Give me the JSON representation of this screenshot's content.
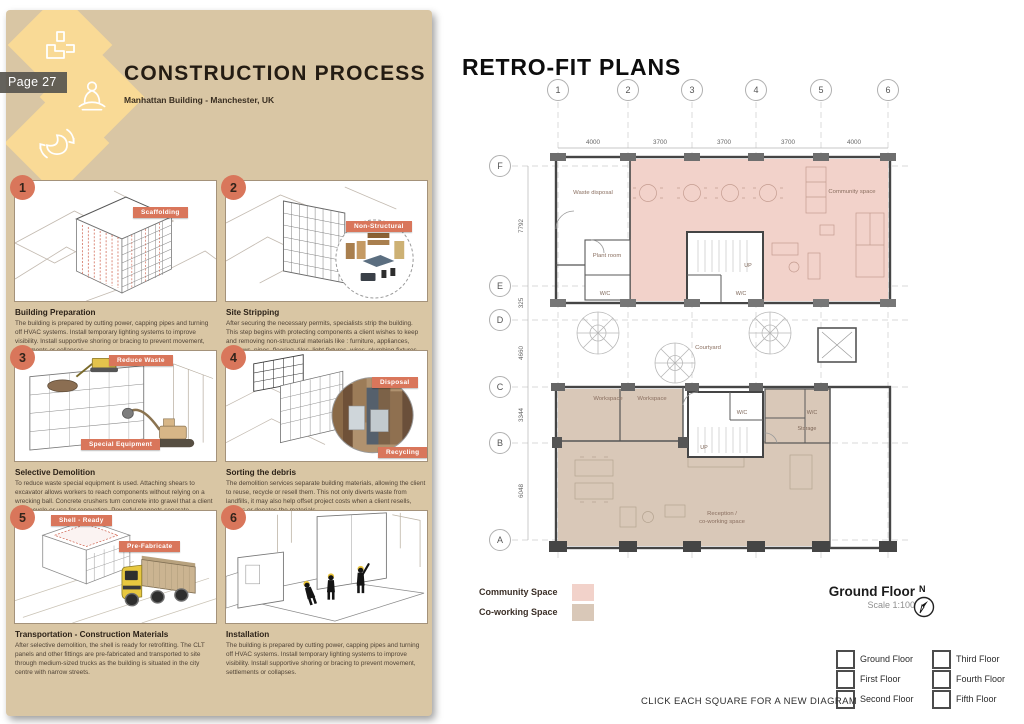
{
  "page_badge": "Page 27",
  "left": {
    "title": "CONSTRUCTION PROCESS",
    "subtitle": "Manhattan Building - Manchester, UK",
    "steps": [
      {
        "num": "1",
        "heading": "Building Preparation",
        "tag1": "Scaffolding",
        "body": "The building is prepared by cutting power, capping pipes and turning off HVAC systems. Install temporary lighting systems to improve visibility. Install supportive shoring or bracing to prevent movement, settlements or collapses."
      },
      {
        "num": "2",
        "heading": "Site Stripping",
        "tag1": "Non-Structural",
        "body": "After securing the necessary permits, specialists strip the building. This step begins with protecting components a client wishes to keep and removing non-structural materials like : furniture, appliances, windows, pipes, flooring, tiles, light fixtures, wires, plumbing fixtures."
      },
      {
        "num": "3",
        "heading": "Selective Demolition",
        "tag1": "Reduce Waste",
        "tag2": "Special Equipment",
        "body": "To reduce waste special equipment is used. Attaching shears to excavator allows workers to reach components without relying on a wrecking ball. Concrete crushers turn concrete into gravel that a client can recycle or use for renovation. Powerful magnets separate"
      },
      {
        "num": "4",
        "heading": "Sorting the debris",
        "tag1": "Disposal",
        "tag2": "Recycling",
        "body": "The demolition services separate building materials, allowing the client to reuse, recycle or resell them. This not only diverts waste from landfills, it may also help offset project costs when a client resells, reuses or donates the materials."
      },
      {
        "num": "5",
        "heading": "Transportation - Construction Materials",
        "tag1": "Shell - Ready",
        "tag2": "Pre-Fabricate",
        "body": "After selective demolition, the shell is ready for retrofitting. The CLT panels and other fittings are pre-fabricated and transported to site through medium-sized trucks as the building is situated in the city centre with narrow streets."
      },
      {
        "num": "6",
        "heading": "Installation",
        "body": "The building is prepared by cutting power, capping pipes and turning off HVAC systems. Install temporary lighting systems to improve visibility. Install supportive shoring or bracing to prevent movement, settlements or collapses."
      }
    ]
  },
  "right": {
    "title": "RETRO-FIT PLANS",
    "plan": {
      "columns": [
        "1",
        "2",
        "3",
        "4",
        "5",
        "6"
      ],
      "rows": [
        "F",
        "E",
        "D",
        "C",
        "B",
        "A"
      ],
      "top_dims": [
        "4000",
        "3700",
        "3700",
        "3700",
        "4000"
      ],
      "left_dims": [
        "7792",
        "325",
        "4660",
        "3344",
        "6048"
      ],
      "labels": {
        "waste_disposal": "Waste disposal",
        "plant_room": "Plant room",
        "wc": "W/C",
        "community_space": "Community space",
        "courtyard": "Courtyard",
        "workspace": "Workspace",
        "storage": "Storage",
        "reception_1": "Reception /",
        "reception_2": "co-working space",
        "up": "UP"
      }
    },
    "legend": [
      {
        "label": "Community Space",
        "color": "#f2d2ca"
      },
      {
        "label": "Co-working Space",
        "color": "#d9c8b8"
      }
    ],
    "floor_title": "Ground Floor",
    "scale_note": "Scale 1:100",
    "north_letter": "N",
    "floors": [
      "Ground Floor",
      "First Floor",
      "Second Floor",
      "Third Floor",
      "Fourth Floor",
      "Fifth Floor"
    ],
    "footer_note": "CLICK EACH SQUARE FOR A NEW DIAGRAM"
  },
  "colors": {
    "sheet_bg": "#d9c6a4",
    "accent": "#d9765b",
    "diamond": "#f9da96",
    "community_fill": "#f2d2ca",
    "coworking_fill": "#d9c8b8"
  }
}
